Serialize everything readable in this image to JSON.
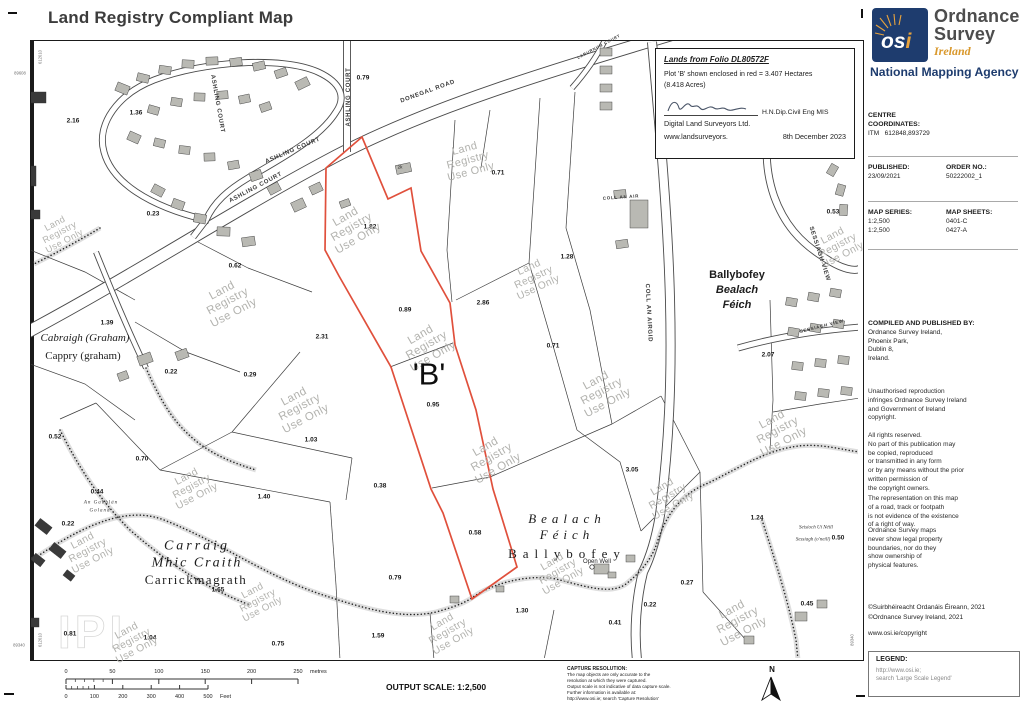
{
  "title": "Land Registry Compliant Map",
  "logo": {
    "osi_os": "os",
    "osi_i": "i",
    "line1": "Ordnance",
    "line2": "Survey",
    "country": "Ireland",
    "tagline": "National Mapping Agency"
  },
  "info_box": {
    "folio_title": "Lands from Folio DL80572F",
    "plot_line1": "Plot 'B' shown enclosed in red = 3.407 Hectares",
    "plot_line2": "(8.418 Acres)",
    "qualification": "H.N.Dip.Civil Eng MIS",
    "company": "Digital Land Surveyors Ltd.",
    "website": "www.landsurveyors.",
    "date": "8th December 2023"
  },
  "sidebar": {
    "centre_heading": "CENTRE\nCOORDINATES:",
    "centre_value": "ITM   612848,893729",
    "published_heading": "PUBLISHED:",
    "published_value": "23/09/2021",
    "order_heading": "ORDER NO.:",
    "order_value": "50222002_1",
    "series_heading": "MAP SERIES:",
    "series_values": "1:2,500\n1:2,500",
    "sheets_heading": "MAP SHEETS:",
    "sheets_values": "0401-C\n0427-A",
    "compiled_heading": "COMPILED AND PUBLISHED BY:",
    "compiled_lines": "Ordnance Survey Ireland,\nPhoenix Park,\nDublin 8,\nIreland.",
    "para1": "Unauthorised reproduction\ninfringes Ordnance Survey Ireland\nand Government of Ireland\ncopyright.",
    "para2": "All rights reserved.\nNo part of this publication may\nbe copied, reproduced\nor transmitted in any form\nor by any means without the prior\nwritten permission of\nthe copyright owners.",
    "para3": "The representation on this map\nof a road, track or footpath\nis not evidence of the existence\nof a right of way.",
    "para4": "Ordnance Survey maps\nnever show legal property\nboundaries, nor do they\nshow ownership of\nphysical features.",
    "copyright1": "©Suirbhéireacht Ordanáis Éireann, 2021",
    "copyright2": "©Ordnance Survey Ireland, 2021",
    "copyright_url": "www.osi.ie/copyright",
    "legend_heading": "LEGEND:",
    "legend_line1": "http://www.osi.ie;",
    "legend_line2": "search 'Large Scale Legend'"
  },
  "footer": {
    "output_scale": "OUTPUT SCALE: 1:2,500",
    "capture_heading": "CAPTURE RESOLUTION:",
    "capture_lines": [
      "The map objects are only accurate to the",
      "resolution at which they were captured.",
      "Output scale is not indicative of data capture scale.",
      "Further information is available at:",
      "http://www.osi.ie; search 'Capture Resolution'"
    ],
    "north_label": "N",
    "scale_bar": {
      "metre_ticks": [
        "0",
        "50",
        "100",
        "150",
        "200",
        "250"
      ],
      "metre_unit": "metres",
      "feet_ticks": [
        "0",
        "100",
        "200",
        "300",
        "400",
        "500"
      ],
      "feet_unit": "Feet"
    }
  },
  "map": {
    "plot_label": "'B'",
    "watermark_text": "Land\nRegistry\nUse Only",
    "ghost_mark": "IPI",
    "colors": {
      "plot_outline": "#e0503c",
      "building": "#b9b9b3",
      "building_dark": "#3a3a3a",
      "road_casing": "#4a4a4a",
      "watermark": "#b2b2ae",
      "navy": "#1e3c6e",
      "gold": "#e8a33d"
    },
    "parcel_areas": [
      [
        "2.16",
        73,
        121
      ],
      [
        "1.36",
        136,
        113
      ],
      [
        "0.79",
        363,
        78
      ],
      [
        "0.23",
        153,
        214
      ],
      [
        "0.62",
        235,
        266
      ],
      [
        "1.39",
        107,
        323
      ],
      [
        "0.22",
        171,
        372
      ],
      [
        "0.29",
        250,
        375
      ],
      [
        "2.31",
        322,
        337
      ],
      [
        "1.82",
        370,
        227
      ],
      [
        "0.89",
        405,
        310
      ],
      [
        "2.86",
        483,
        303
      ],
      [
        "0.71",
        498,
        173
      ],
      [
        "1.28",
        567,
        257
      ],
      [
        "0.71",
        553,
        346
      ],
      [
        "0.95",
        433,
        405
      ],
      [
        "0.58",
        475,
        533
      ],
      [
        "3.05",
        632,
        470
      ],
      [
        "1.24",
        757,
        518
      ],
      [
        "0.27",
        687,
        583
      ],
      [
        "0.22",
        650,
        605
      ],
      [
        "0.41",
        615,
        623
      ],
      [
        "1.30",
        522,
        611
      ],
      [
        "0.79",
        395,
        578
      ],
      [
        "1.59",
        378,
        636
      ],
      [
        "1.65",
        218,
        590
      ],
      [
        "1.40",
        264,
        497
      ],
      [
        "0.38",
        380,
        486
      ],
      [
        "1.03",
        311,
        440
      ],
      [
        "0.52",
        55,
        437
      ],
      [
        "0.70",
        142,
        459
      ],
      [
        "0.44",
        97,
        492
      ],
      [
        "0.22",
        68,
        524
      ],
      [
        "0.81",
        70,
        634
      ],
      [
        "1.04",
        150,
        638
      ],
      [
        "0.75",
        278,
        644
      ],
      [
        "2.07",
        768,
        355
      ],
      [
        "0.53",
        833,
        212
      ],
      [
        "0.50",
        838,
        538
      ],
      [
        "0.45",
        807,
        604
      ]
    ],
    "watermarks": [
      [
        60,
        233,
        -28,
        0.8
      ],
      [
        228,
        302,
        -28,
        1
      ],
      [
        352,
        228,
        -30,
        1
      ],
      [
        300,
        408,
        -28,
        1
      ],
      [
        427,
        346,
        -30,
        1
      ],
      [
        492,
        458,
        -30,
        1
      ],
      [
        534,
        278,
        -25,
        0.9
      ],
      [
        602,
        392,
        -28,
        1
      ],
      [
        668,
        497,
        -30,
        0.9
      ],
      [
        778,
        431,
        -28,
        1
      ],
      [
        738,
        621,
        -28,
        1
      ],
      [
        558,
        572,
        -30,
        0.9
      ],
      [
        448,
        632,
        -30,
        0.9
      ],
      [
        132,
        641,
        -28,
        0.9
      ],
      [
        88,
        551,
        -28,
        0.9
      ],
      [
        468,
        161,
        -15,
        0.95
      ],
      [
        838,
        246,
        -28,
        0.9
      ],
      [
        192,
        487,
        -28,
        0.9
      ],
      [
        258,
        601,
        -28,
        0.85
      ]
    ],
    "road_labels": [
      {
        "t": "DONEGAL ROAD",
        "x": 428,
        "y": 92,
        "r": -20
      },
      {
        "t": "ASHLING COURT",
        "x": 349,
        "y": 97,
        "r": -90
      },
      {
        "t": "ASHLING COURT",
        "x": 217,
        "y": 104,
        "r": 80
      },
      {
        "t": "ASHLING COURT",
        "x": 293,
        "y": 151,
        "r": -23
      },
      {
        "t": "ASHLING COURT",
        "x": 256,
        "y": 188,
        "r": -28
      },
      {
        "t": "COLL AN AIRGID",
        "x": 648,
        "y": 313,
        "r": 87
      },
      {
        "t": "COLL AN AIR",
        "x": 621,
        "y": 198,
        "r": -4,
        "fs": 4.5
      },
      {
        "t": "SESSIAGH VIEW",
        "x": 819,
        "y": 254,
        "r": 72
      },
      {
        "t": "SESSIAGH VIEW",
        "x": 822,
        "y": 327,
        "r": -14,
        "fs": 4.5
      },
      {
        "t": "LABURNUM COURT",
        "x": 599,
        "y": 47,
        "r": -28,
        "fs": 4
      }
    ],
    "place_labels": [
      {
        "t": "Cabraigh (Graham)",
        "x": 85,
        "y": 339,
        "cls": "serif-i",
        "fs": 11
      },
      {
        "t": "Cappry (graham)",
        "x": 83,
        "y": 357,
        "cls": "serif",
        "fs": 11
      },
      {
        "t": "Carraig",
        "x": 197,
        "y": 546,
        "cls": "serif-i",
        "fs": 14,
        "ls": 3
      },
      {
        "t": "Mhic Craith",
        "x": 197,
        "y": 563,
        "cls": "serif-i",
        "fs": 14,
        "ls": 2
      },
      {
        "t": "Carrickmagrath",
        "x": 196,
        "y": 580,
        "cls": "serif",
        "fs": 13,
        "ls": 1.5
      },
      {
        "t": "Bealach",
        "x": 567,
        "y": 519,
        "cls": "serif-i",
        "fs": 13,
        "ls": 5
      },
      {
        "t": "Féich",
        "x": 567,
        "y": 535,
        "cls": "serif-i",
        "fs": 13,
        "ls": 5
      },
      {
        "t": "Ballybofey",
        "x": 567,
        "y": 554,
        "cls": "serif",
        "fs": 13,
        "ls": 6
      },
      {
        "t": "Ballybofey",
        "x": 737,
        "y": 276,
        "cls": "sans-b",
        "fs": 11
      },
      {
        "t": "Bealach",
        "x": 737,
        "y": 291,
        "cls": "sans-bi",
        "fs": 11
      },
      {
        "t": "Féich",
        "x": 737,
        "y": 306,
        "cls": "sans-bi",
        "fs": 11
      },
      {
        "t": "Seisíoch Uí Néill",
        "x": 816,
        "y": 528,
        "cls": "tiny-i",
        "fs": 5
      },
      {
        "t": "Sessiagh (o'neill)",
        "x": 813,
        "y": 540,
        "cls": "tiny-i",
        "fs": 5
      },
      {
        "t": "An Gabhlán",
        "x": 101,
        "y": 503,
        "cls": "tiny-i",
        "fs": 5,
        "ls": 1
      },
      {
        "t": "Goland",
        "x": 100,
        "y": 511,
        "cls": "tiny-i",
        "fs": 5,
        "ls": 1
      },
      {
        "t": "Open Well",
        "x": 597,
        "y": 562,
        "cls": "tiny",
        "fs": 6
      },
      {
        "t": "2k",
        "x": 400,
        "y": 168,
        "cls": "tiny",
        "fs": 4.5
      }
    ],
    "edge_labels": [
      {
        "t": "89608",
        "x": 20,
        "y": 74,
        "r": 0
      },
      {
        "t": "612610",
        "x": 41,
        "y": 57,
        "r": -90
      },
      {
        "t": "89340",
        "x": 19,
        "y": 646,
        "r": 0
      },
      {
        "t": "612610",
        "x": 41,
        "y": 640,
        "r": -90
      },
      {
        "t": "89608",
        "x": 853,
        "y": 57,
        "r": -90
      },
      {
        "t": "89340",
        "x": 853,
        "y": 640,
        "r": -90
      }
    ]
  }
}
